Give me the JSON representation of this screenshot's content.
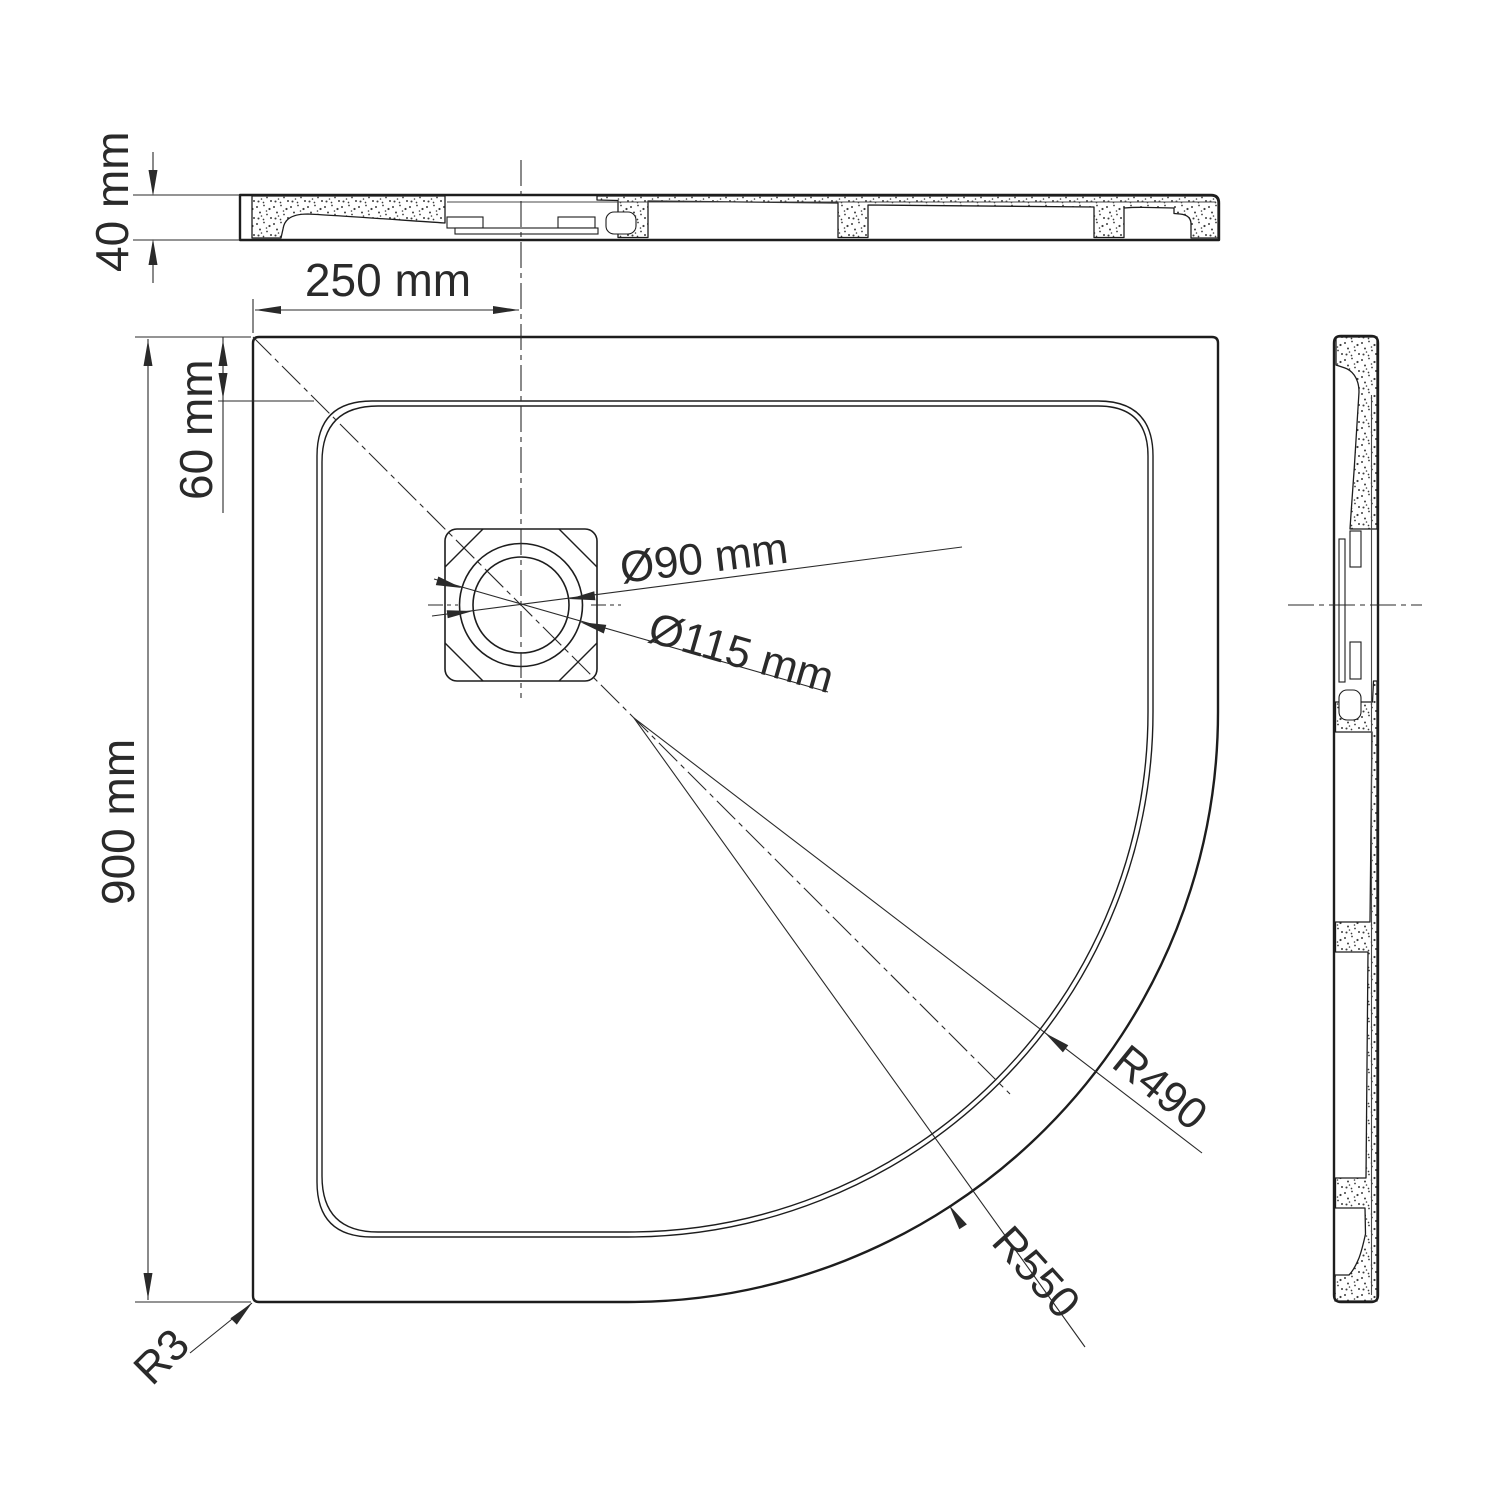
{
  "drawing": {
    "type": "technical-drawing-shower-tray",
    "views": {
      "top_section": "front sectional profile",
      "plan": "plan view with quadrant corner",
      "side_section": "right sectional profile"
    },
    "labels": {
      "thickness": "40 mm",
      "drain_offset": "250 mm",
      "rim_width": "60 mm",
      "overall_size": "900 mm",
      "drain_inner_dia": "Ø90 mm",
      "drain_outer_dia": "Ø115 mm",
      "inner_corner_radius": "R490",
      "outer_corner_radius": "R550",
      "edge_radius": "R3"
    },
    "colors": {
      "line": "#1d1d1d",
      "text": "#2a2a2a",
      "background": "#ffffff"
    }
  }
}
